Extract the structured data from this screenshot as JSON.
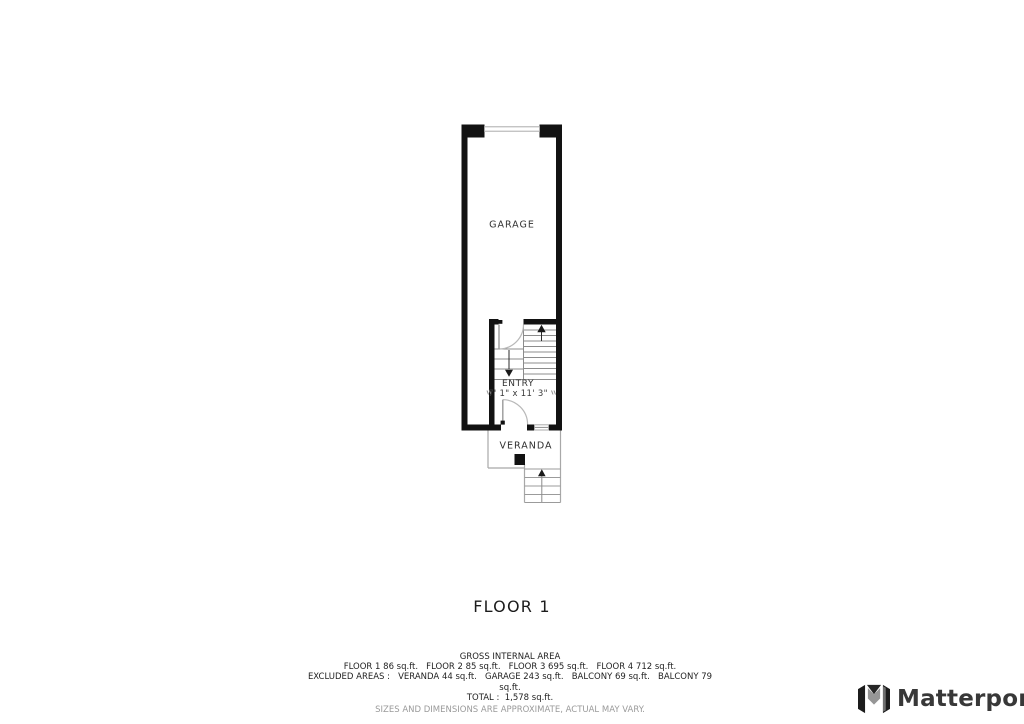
{
  "plan": {
    "title": "FLOOR 1",
    "rooms": {
      "garage": {
        "label": "GARAGE"
      },
      "entry": {
        "label": "ENTRY",
        "dimensions": "7' 1\" x 11' 3\""
      },
      "veranda": {
        "label": "VERANDA"
      }
    }
  },
  "footer": {
    "heading": "GROSS INTERNAL AREA",
    "floors_line": "FLOOR 1 86 sq.ft.   FLOOR 2 85 sq.ft.   FLOOR 3 695 sq.ft.   FLOOR 4 712 sq.ft.",
    "excluded_line": "EXCLUDED AREAS :   VERANDA 44 sq.ft.   GARAGE 243 sq.ft.   BALCONY 69 sq.ft.   BALCONY 79",
    "excluded_line_overflow": "sq.ft.",
    "total_line": "TOTAL :  1,578 sq.ft.",
    "disclaimer": "SIZES AND DIMENSIONS ARE APPROXIMATE, ACTUAL MAY VARY.",
    "areas": {
      "floors": [
        {
          "name": "FLOOR 1",
          "sqft": 86
        },
        {
          "name": "FLOOR 2",
          "sqft": 85
        },
        {
          "name": "FLOOR 3",
          "sqft": 695
        },
        {
          "name": "FLOOR 4",
          "sqft": 712
        }
      ],
      "excluded": [
        {
          "name": "VERANDA",
          "sqft": 44
        },
        {
          "name": "GARAGE",
          "sqft": 243
        },
        {
          "name": "BALCONY",
          "sqft": 69
        },
        {
          "name": "BALCONY",
          "sqft": 79
        }
      ],
      "total_sqft": "1,578"
    }
  },
  "branding": {
    "wordmark": "Matterport"
  },
  "colors": {
    "wall": "#121212",
    "thin_line": "#a8a8a8",
    "stair_line": "#8c8c8c",
    "text": "#333333",
    "muted": "#9a9a9a"
  }
}
